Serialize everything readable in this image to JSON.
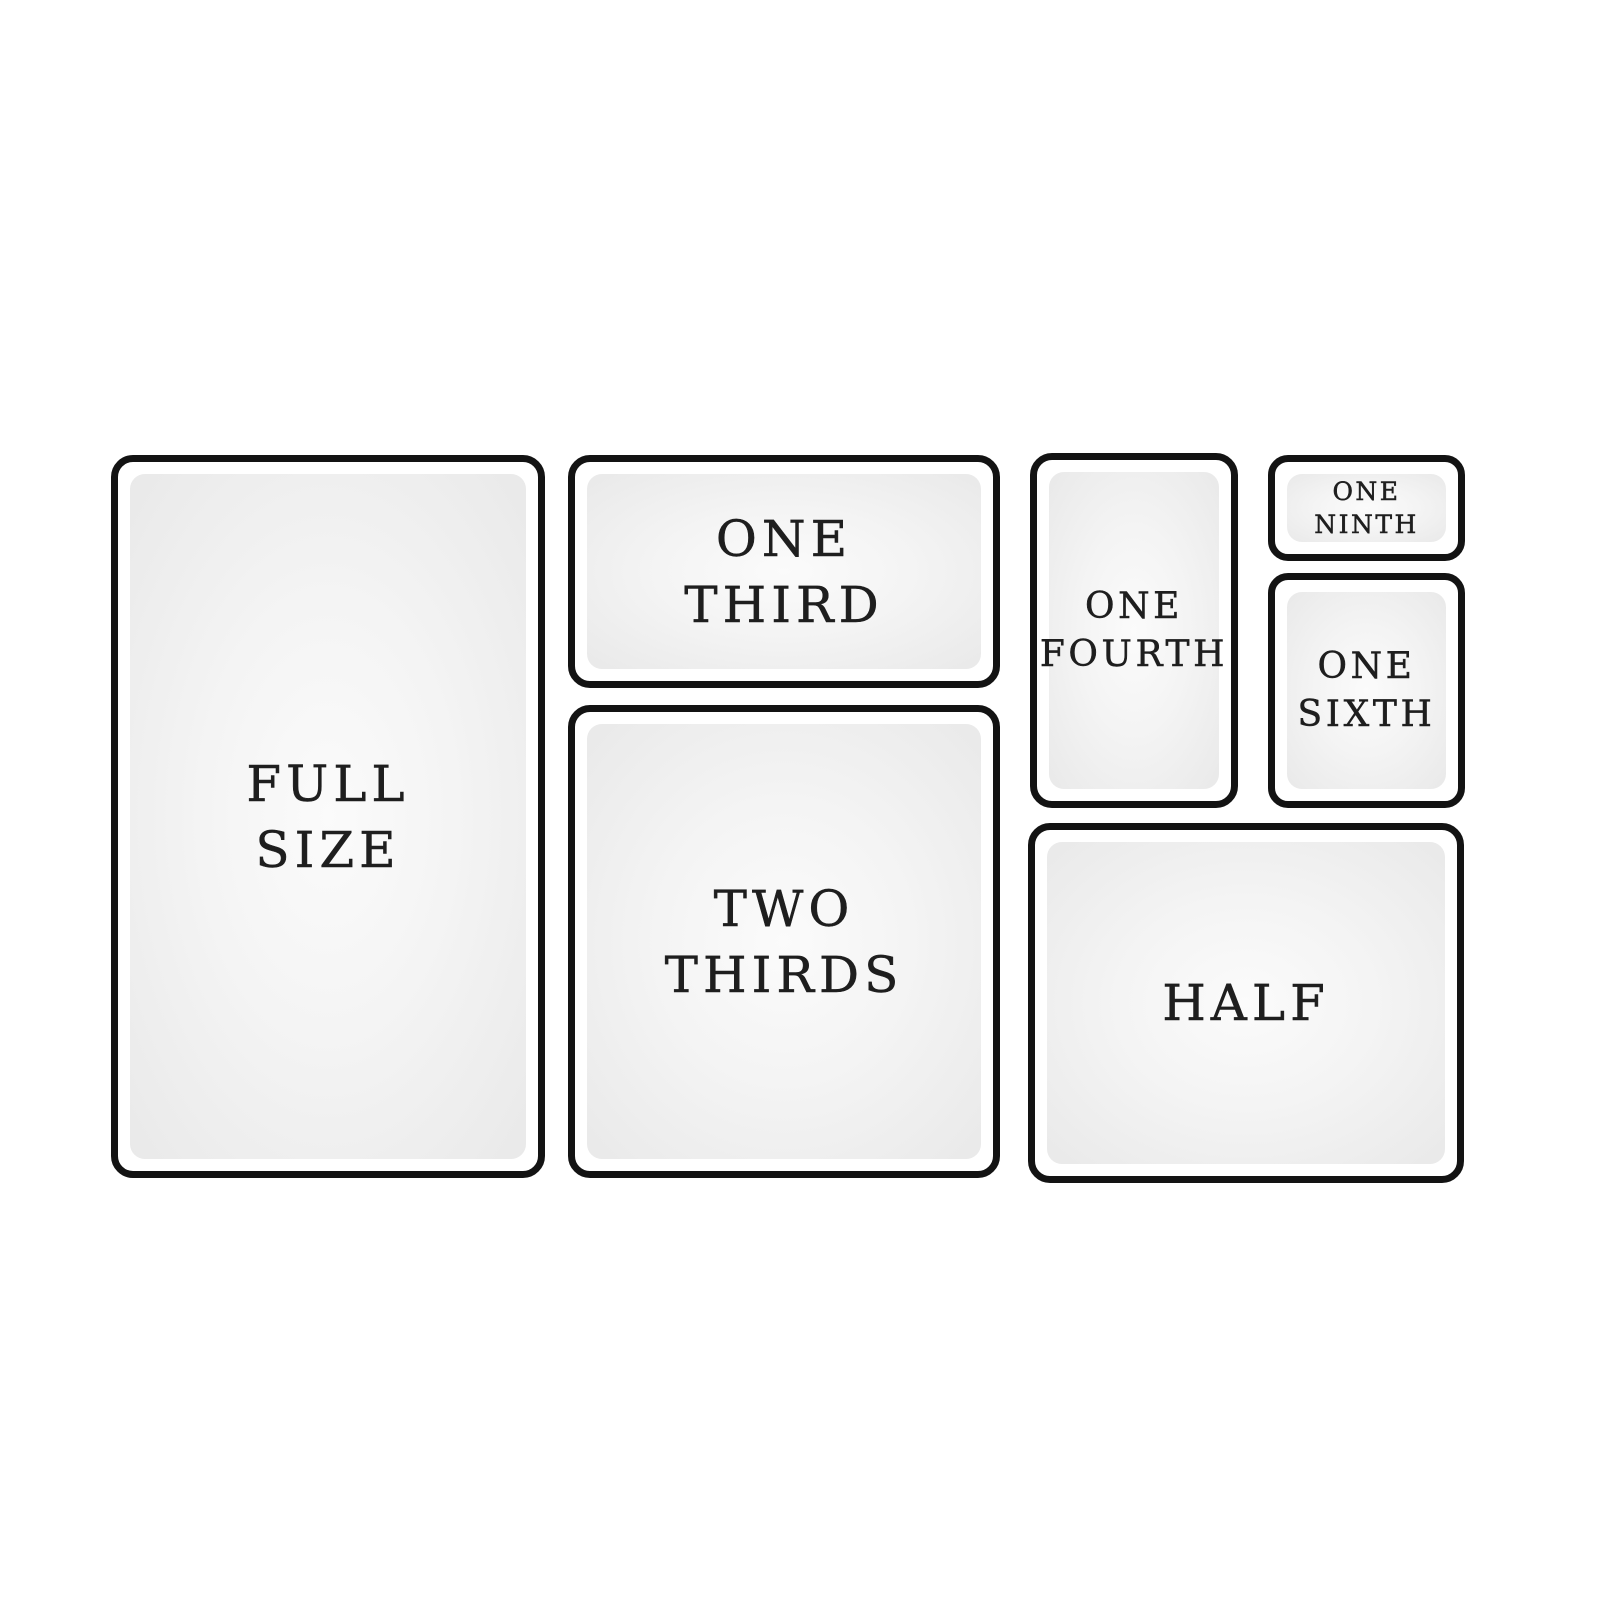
{
  "colors": {
    "background": "#ffffff",
    "panel_border": "#131313",
    "panel_fill_edge": "#e9e9e9",
    "panel_fill_center": "#fbfbfb",
    "label_text": "#1e1e1e"
  },
  "panels": [
    {
      "name": "full-size",
      "line1": "FULL",
      "line2": "SIZE"
    },
    {
      "name": "one-third",
      "line1": "ONE",
      "line2": "THIRD"
    },
    {
      "name": "two-thirds",
      "line1": "TWO",
      "line2": "THIRDS"
    },
    {
      "name": "one-fourth",
      "line1": "ONE",
      "line2": "FOURTH"
    },
    {
      "name": "one-ninth",
      "line1": "ONE",
      "line2": "NINTH"
    },
    {
      "name": "one-sixth",
      "line1": "ONE",
      "line2": "SIXTH"
    },
    {
      "name": "half",
      "line1": "HALF"
    }
  ]
}
